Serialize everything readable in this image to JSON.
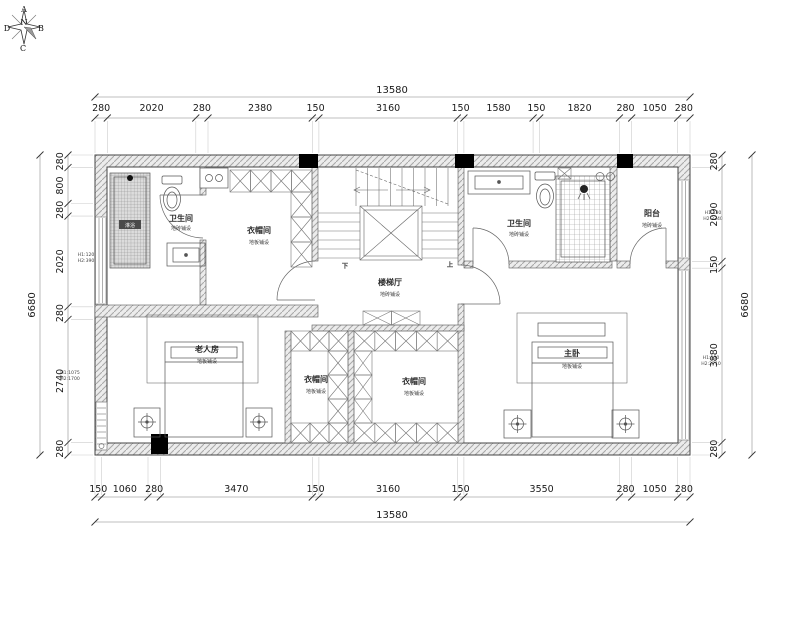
{
  "compass": {
    "a": "A",
    "b": "B",
    "c": "C",
    "d": "D",
    "n": "N"
  },
  "dims": {
    "total_h": "13580",
    "total_v": "6680",
    "top": [
      "280",
      "2020",
      "280",
      "2380",
      "150",
      "3160",
      "150",
      "1580",
      "150",
      "1820",
      "280",
      "1050",
      "280"
    ],
    "bottom": [
      "150",
      "1060",
      "280",
      "3470",
      "150",
      "3160",
      "150",
      "3550",
      "280",
      "1050",
      "280"
    ],
    "left": [
      "280",
      "800",
      "280",
      "2020",
      "280",
      "2740",
      "280"
    ],
    "right": [
      "280",
      "2090",
      "150",
      "3880",
      "280"
    ]
  },
  "annotations": {
    "left_upper": [
      "H1:120",
      "H2:390"
    ],
    "left_lower": [
      "H1:1075",
      "H2:1700"
    ],
    "right_upper": [
      "H1:130",
      "H2:2340"
    ],
    "right_lower": [
      "H1:130",
      "H2:2710"
    ]
  },
  "rooms": {
    "bath_left": {
      "name": "卫生间",
      "finish": "地砖铺设"
    },
    "cloak_top": {
      "name": "衣帽间",
      "finish": "地板铺设"
    },
    "stair_hall": {
      "name": "楼梯厅",
      "finish": "地砖铺设"
    },
    "bath_right": {
      "name": "卫生间",
      "finish": "地砖铺设"
    },
    "balcony": {
      "name": "阳台",
      "finish": "地砖铺设"
    },
    "elder_room": {
      "name": "老人房",
      "finish": "地板铺设"
    },
    "cloak_bl": {
      "name": "衣帽间",
      "finish": "地板铺设"
    },
    "cloak_br": {
      "name": "衣帽间",
      "finish": "地板铺设"
    },
    "master": {
      "name": "主卧",
      "finish": "地板铺设"
    }
  },
  "stairs": {
    "down": "下",
    "up": "上"
  },
  "fixtures": {
    "shower_label": "淋浴"
  },
  "colors": {
    "wall_hatch": "#a8a8a8",
    "column": "#000000",
    "line": "#444444",
    "dim": "#1a1a1a"
  }
}
